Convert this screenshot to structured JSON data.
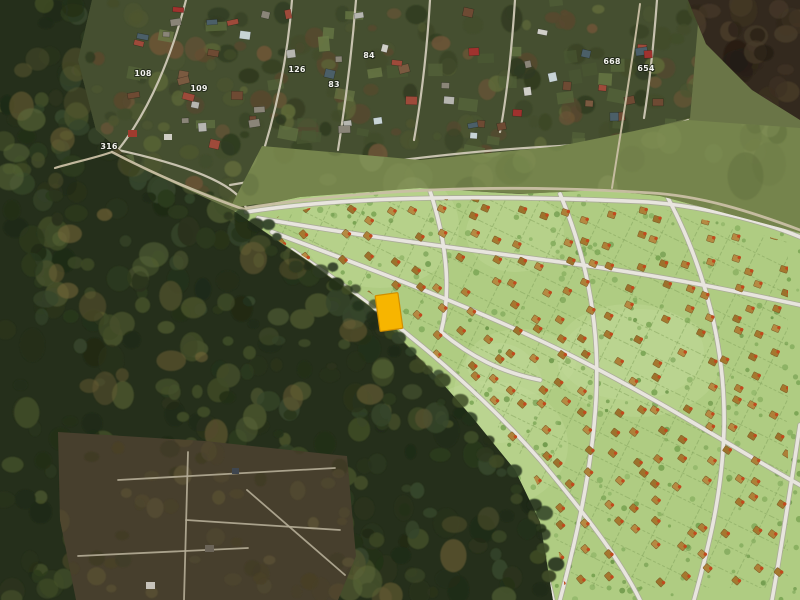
{
  "map": {
    "labels": [
      {
        "text": "316",
        "x": 109,
        "y": 149
      },
      {
        "text": "108",
        "x": 143,
        "y": 76
      },
      {
        "text": "109",
        "x": 199,
        "y": 91
      },
      {
        "text": "126",
        "x": 297,
        "y": 72
      },
      {
        "text": "83",
        "x": 334,
        "y": 87
      },
      {
        "text": "84",
        "x": 369,
        "y": 58
      },
      {
        "text": "668",
        "x": 612,
        "y": 64
      },
      {
        "text": "654",
        "x": 646,
        "y": 71
      }
    ],
    "selected_plot": {
      "x": 389,
      "y": 312,
      "width": 23,
      "height": 36,
      "rotation": -8,
      "color": "#F7B500"
    },
    "colors": {
      "selected_plot": "#F7B500",
      "selected_plot_border": "#D18E00",
      "plan_green": "#AFCC82",
      "plan_road": "#E8E5DE",
      "plan_road_casing": "#A9A69B",
      "parcel_line": "#86A55E",
      "house_icon": "#AD8038",
      "house_dot": "#C2491D",
      "forest_dark": "#252F1B",
      "field_olive": "#75844C",
      "village_ground": "#454F30",
      "dirt_road": "#C9BFA4",
      "corner_soil": "#33291E",
      "label_text": "#F2F2EE"
    }
  }
}
